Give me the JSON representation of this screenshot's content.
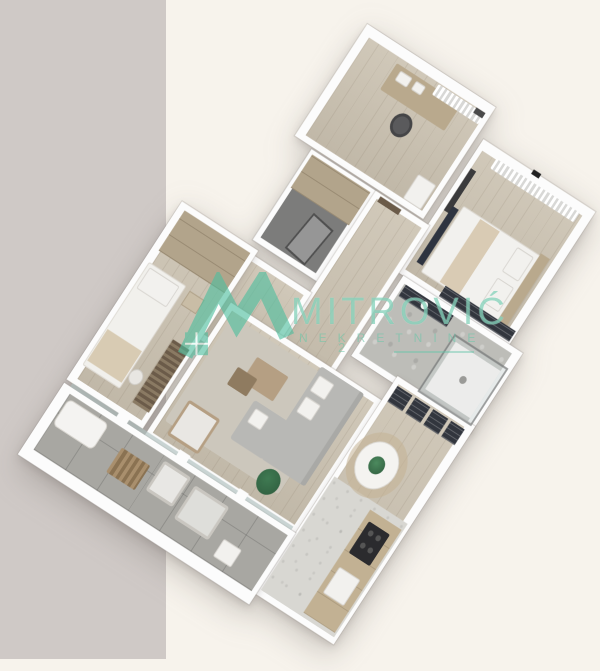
{
  "watermark": {
    "brand": "MITROVIĆ",
    "subtitle": "NEKRETNINE",
    "extra": "2",
    "logo_icon": "house-m-logo"
  },
  "colors": {
    "accent": "#4fbf9f",
    "bg_left": "#cfc9c6",
    "bg_right": "#f7f3ec",
    "wall": "#fcfcfc",
    "wood": "#cbc2b1",
    "terrace_tile": "#a8a7a2",
    "marble": "#d8d7d2",
    "stone": "#bdbdb8",
    "dark_floor": "#7c7c7b",
    "cabinet_wood": "#b2a48b",
    "sofa": "#b8b8b5",
    "dark_navy": "#32363e",
    "plant": "#2e5b3d"
  }
}
